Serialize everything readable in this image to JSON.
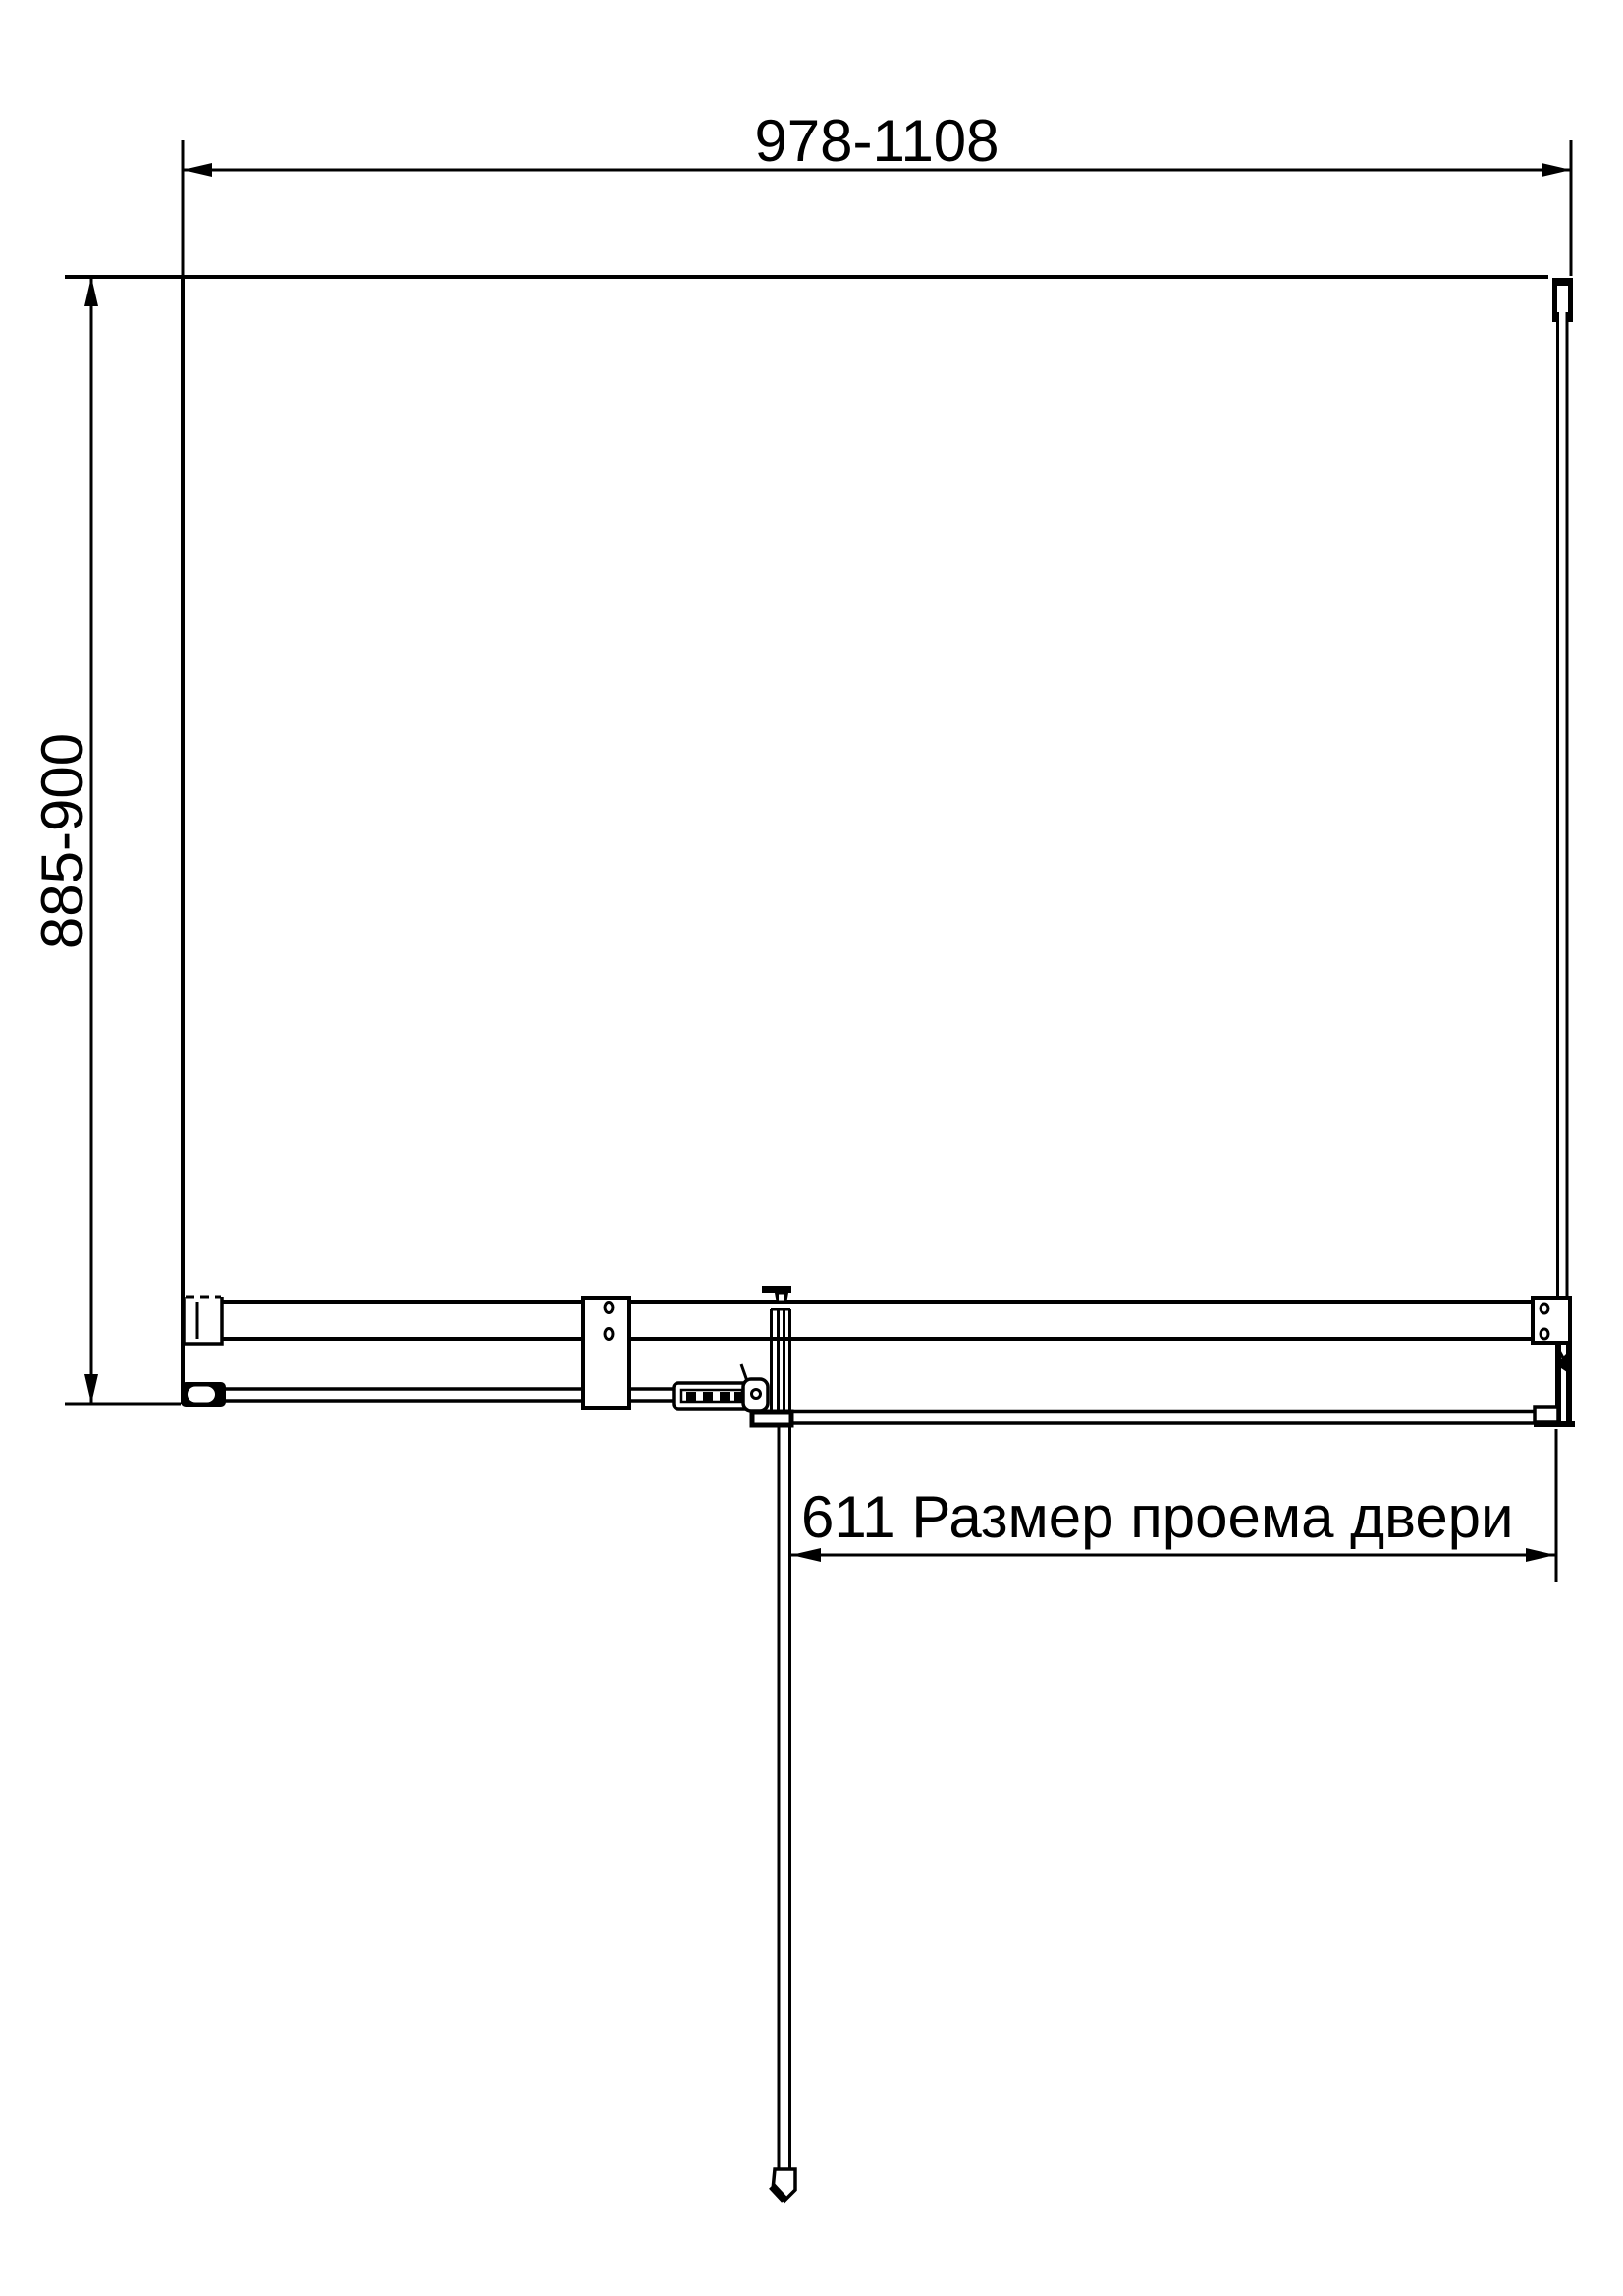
{
  "colors": {
    "ink": "#000000",
    "paper": "#ffffff"
  },
  "annotations": {
    "width_range": "978-1108",
    "depth_range": "885-900",
    "door_opening": "611 Размер проема двери"
  }
}
